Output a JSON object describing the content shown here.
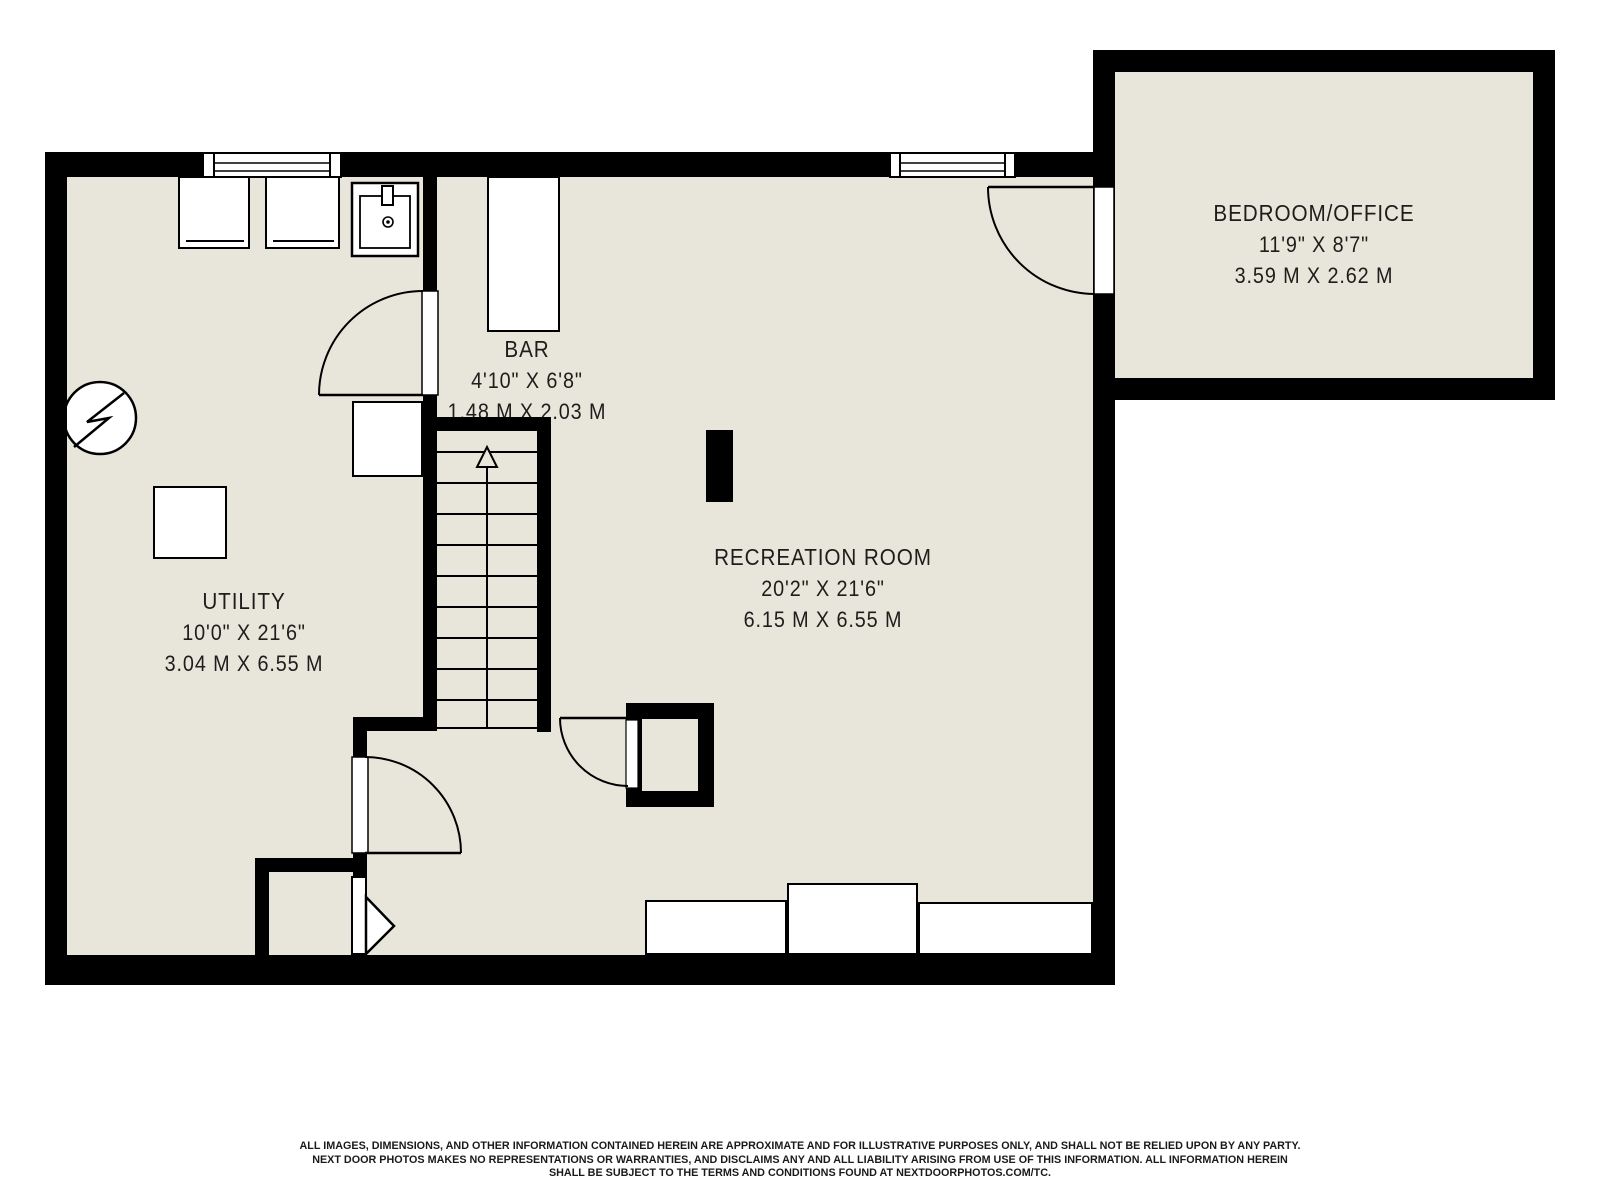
{
  "plan": {
    "title": "Basement floor plan",
    "rooms": [
      {
        "id": "utility",
        "label": "UTILITY",
        "imperial": "10'0\" X 21'6\"",
        "metric": "3.04 M X 6.55 M"
      },
      {
        "id": "bar",
        "label": "BAR",
        "imperial": "4'10\" X 6'8\"",
        "metric": "1.48 M X 2.03 M"
      },
      {
        "id": "recreation",
        "label": "RECREATION ROOM",
        "imperial": "20'2\" X 21'6\"",
        "metric": "6.15 M X 6.55 M"
      },
      {
        "id": "bedroom_office",
        "label": "BEDROOM/OFFICE",
        "imperial": "11'9\" X 8'7\"",
        "metric": "3.59 M X 2.62 M"
      }
    ],
    "symbols": [
      {
        "name": "electrical-panel-icon",
        "glyph": "circle-with-lightning-bolt"
      },
      {
        "name": "staircase-up-arrow",
        "glyph": "hollow-triangle-arrow-up"
      },
      {
        "name": "laundry-sink-icon",
        "glyph": "square-sink-with-faucet"
      },
      {
        "name": "washer-icon",
        "glyph": "appliance-box"
      },
      {
        "name": "dryer-icon",
        "glyph": "appliance-box"
      },
      {
        "name": "window-icon",
        "glyph": "double-line-window"
      },
      {
        "name": "door-icon",
        "glyph": "quarter-arc-swing-door"
      },
      {
        "name": "angled-door-icon",
        "glyph": "white-arrow-pentagon"
      },
      {
        "name": "support-post-icon",
        "glyph": "solid-black-rectangle"
      },
      {
        "name": "furnace-closet-icon",
        "glyph": "walled-mechanical-closet"
      }
    ],
    "colors": {
      "wall": "#000000",
      "floor": "#e8e6db",
      "background": "#ffffff",
      "text": "#1d1d1b"
    }
  },
  "disclaimer": {
    "line1": "ALL IMAGES, DIMENSIONS, AND OTHER INFORMATION CONTAINED HEREIN ARE APPROXIMATE AND FOR ILLUSTRATIVE PURPOSES ONLY, AND SHALL NOT BE RELIED UPON BY ANY PARTY.",
    "line2": "NEXT DOOR PHOTOS MAKES NO REPRESENTATIONS OR WARRANTIES, AND DISCLAIMS ANY AND ALL LIABILITY ARISING FROM USE OF THIS INFORMATION. ALL INFORMATION HEREIN",
    "line3": "SHALL BE SUBJECT TO THE TERMS AND CONDITIONS FOUND AT NEXTDOORPHOTOS.COM/TC."
  }
}
